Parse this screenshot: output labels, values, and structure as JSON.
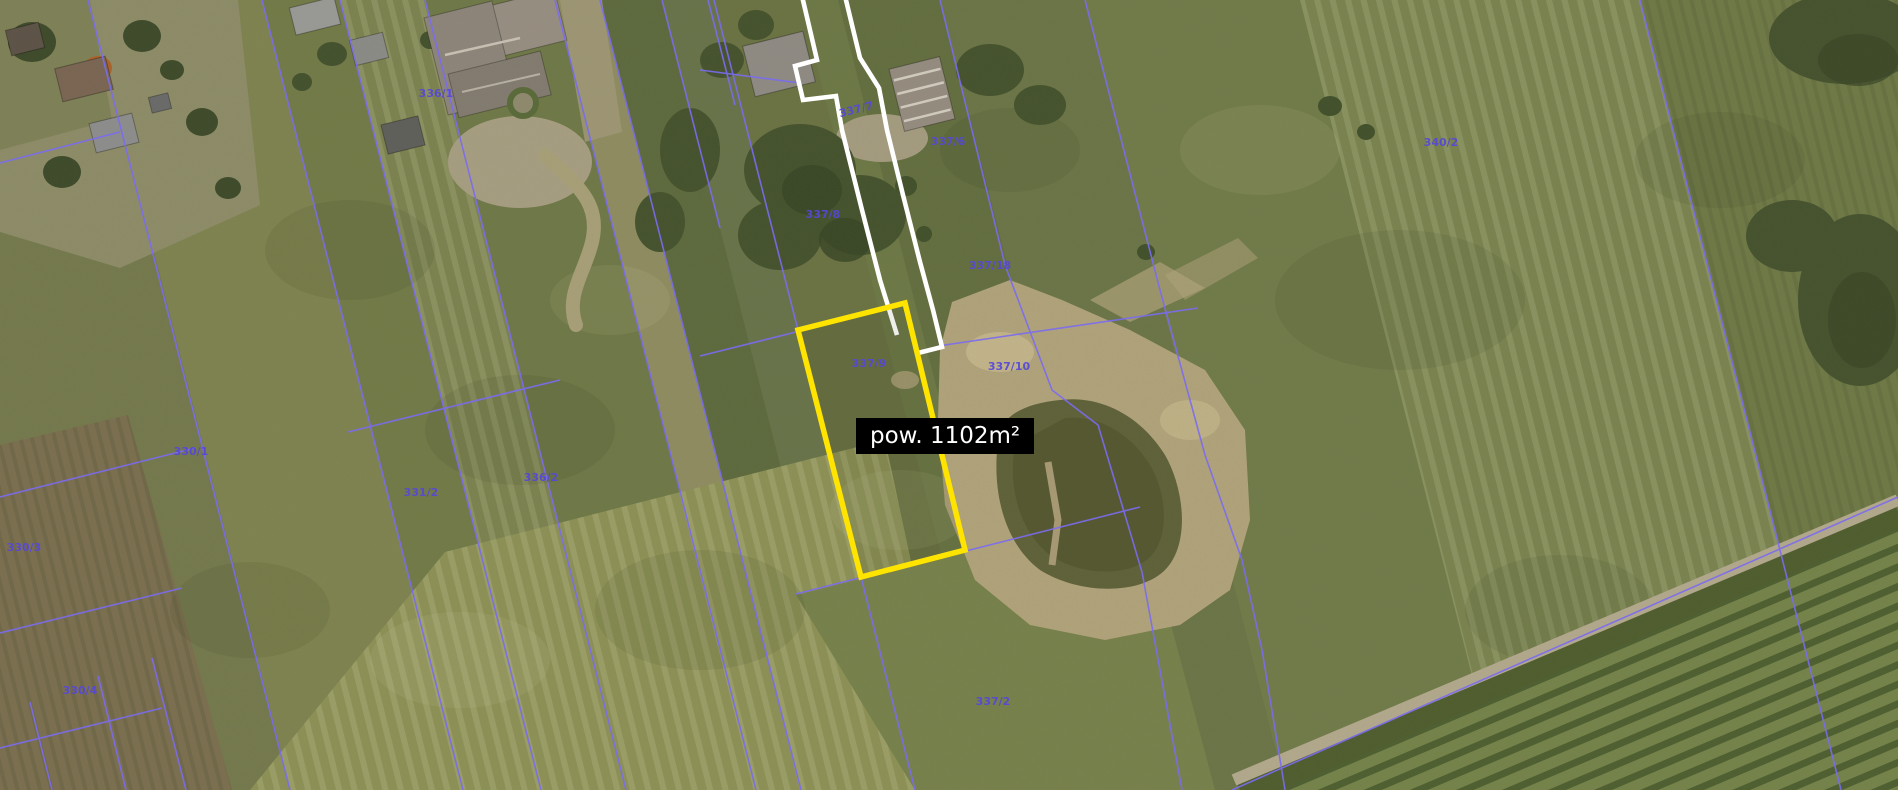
{
  "map": {
    "area_label": {
      "text": "pow. 1102m²"
    },
    "highlight": {
      "parcel": "337/9",
      "outline_color": "#ffe400",
      "selection_path_color": "#ffffff"
    },
    "parcel_labels": [
      {
        "text": "336/1"
      },
      {
        "text": "337/7"
      },
      {
        "text": "337/6"
      },
      {
        "text": "337/8"
      },
      {
        "text": "337/18"
      },
      {
        "text": "337/9"
      },
      {
        "text": "337/10"
      },
      {
        "text": "340/2"
      },
      {
        "text": "330/1"
      },
      {
        "text": "331/2"
      },
      {
        "text": "336/2"
      },
      {
        "text": "330/3"
      },
      {
        "text": "330/4"
      },
      {
        "text": "337/2"
      }
    ],
    "colors": {
      "boundary_line": "#7b6cf0",
      "parcel_label_text": "#5648d8",
      "highlight_outline": "#ffe400",
      "selection_outline": "#ffffff",
      "tooltip_bg": "#000000",
      "tooltip_text": "#ffffff"
    }
  }
}
